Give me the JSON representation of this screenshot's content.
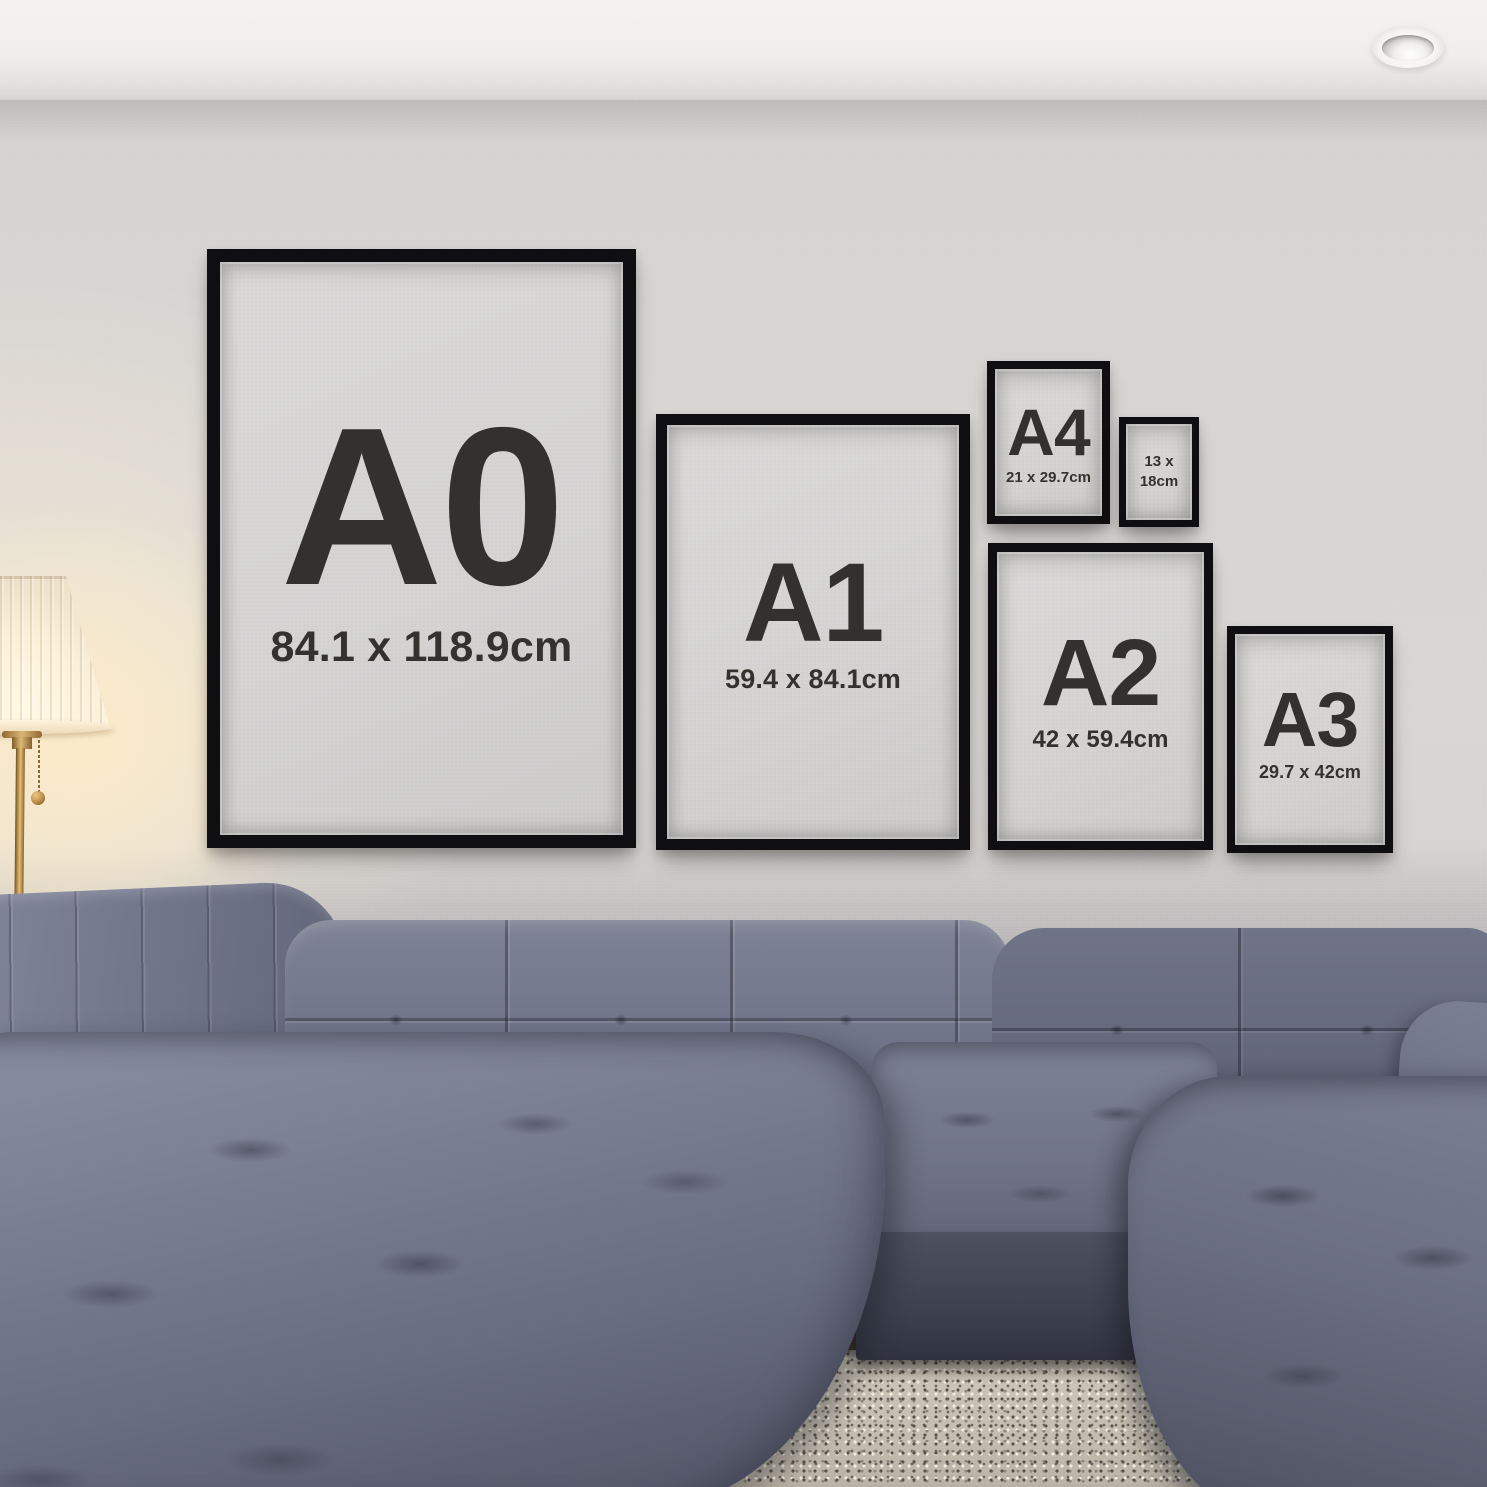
{
  "frames": {
    "a0": {
      "label": "A0",
      "size": "84.1 x 118.9cm"
    },
    "a1": {
      "label": "A1",
      "size": "59.4 x 84.1cm"
    },
    "a2": {
      "label": "A2",
      "size": "42 x 59.4cm"
    },
    "a3": {
      "label": "A3",
      "size": "29.7 x 42cm"
    },
    "a4": {
      "label": "A4",
      "size": "21 x 29.7cm"
    },
    "f13x18": {
      "size_line1": "13 x",
      "size_line2": "18cm"
    }
  },
  "colors": {
    "frame_border": "#0f0f11",
    "frame_mat": "#d3d2d1",
    "frame_text": "#323130",
    "wall": "#d6d4d2",
    "ceiling": "#f2f1ef",
    "sofa_fabric": "#6e7385",
    "rug": "#c8c1b2",
    "wood_floor": "#3a2a20",
    "lamp_glow": "#ffeccb",
    "lamp_brass": "#caa055"
  }
}
